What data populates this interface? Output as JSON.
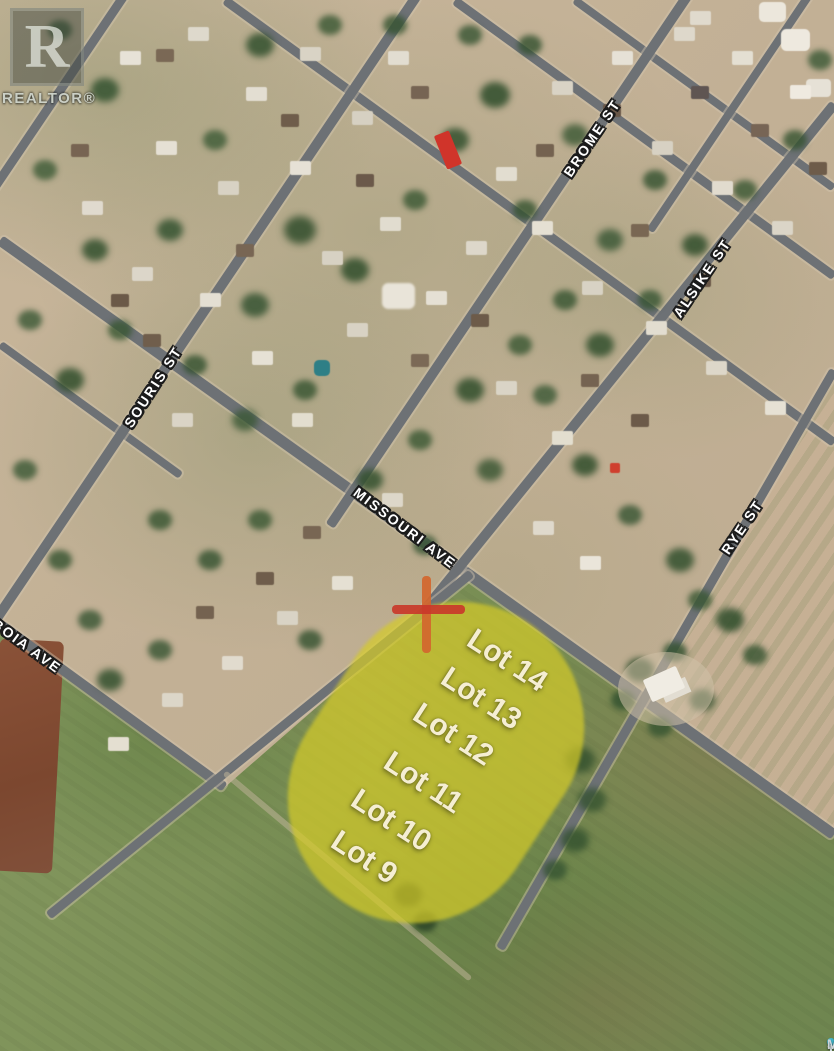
{
  "map": {
    "type": "satellite-listing-photo",
    "streets": [
      {
        "id": "souris",
        "label": "SOURIS ST"
      },
      {
        "id": "brome",
        "label": "BROME ST"
      },
      {
        "id": "alsike",
        "label": "ALSIKE ST"
      },
      {
        "id": "rye",
        "label": "RYE ST"
      },
      {
        "id": "missouri",
        "label": "MISSOURI AVE"
      },
      {
        "id": "boia",
        "label": "BOIA AVE"
      }
    ],
    "lots": [
      "Lot 14",
      "Lot 13",
      "Lot 12",
      "Lot 11",
      "Lot 10",
      "Lot 9"
    ],
    "marker": {
      "shape": "cross"
    }
  },
  "watermark": {
    "logo_letter": "R",
    "label": "REALTOR®"
  },
  "branding": {
    "prefix": "SASK",
    "suffix": "MLS®",
    "pin_icon": "map-pin-icon"
  },
  "colors": {
    "highlight_yellow": "#d6cc28",
    "cross_red": "#c9382a",
    "cross_orange": "#d2662e",
    "road_gray": "#6d7175",
    "label_cream": "#f5eed2",
    "pin_teal": "#42b8cc"
  }
}
